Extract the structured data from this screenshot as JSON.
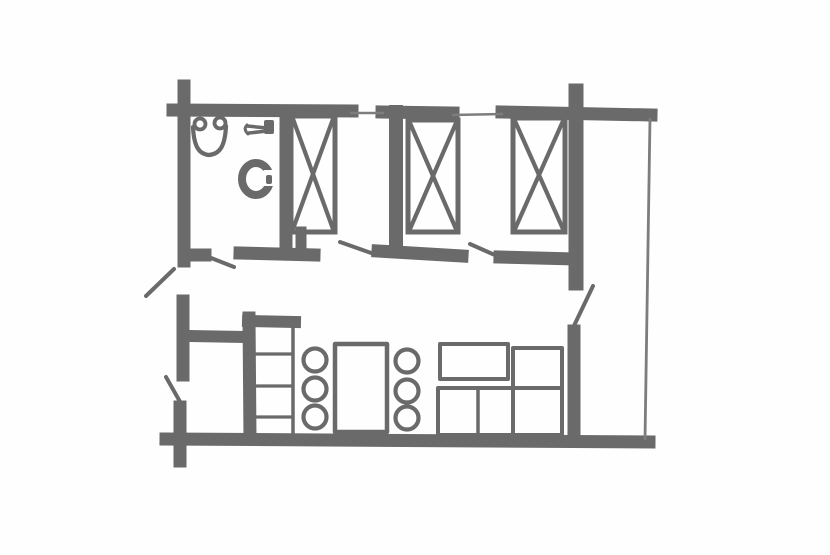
{
  "canvas": {
    "width": 830,
    "height": 555,
    "background": "#fefefe",
    "ink": "#6a6a6a",
    "ink_light": "#7d7d7d"
  },
  "floor_plan": {
    "description_items": [
      {
        "name": "top-wall-left",
        "kind": "wall",
        "x1": 173,
        "y1": 110,
        "x2": 352,
        "y2": 111,
        "sw": 13
      },
      {
        "name": "top-wall-mid",
        "kind": "wall",
        "x1": 382,
        "y1": 112,
        "x2": 453,
        "y2": 113,
        "sw": 13
      },
      {
        "name": "top-wall-right",
        "kind": "wall",
        "x1": 502,
        "y1": 112,
        "x2": 651,
        "y2": 115,
        "sw": 13
      },
      {
        "name": "left-wall-upper",
        "kind": "wall",
        "x1": 184,
        "y1": 86,
        "x2": 184,
        "y2": 261,
        "sw": 13
      },
      {
        "name": "bathroom-divider-wall",
        "kind": "wall",
        "x1": 286,
        "y1": 112,
        "x2": 286,
        "y2": 248,
        "sw": 13
      },
      {
        "name": "bathroom-door-stub",
        "kind": "wall",
        "x1": 189,
        "y1": 255,
        "x2": 205,
        "y2": 255,
        "sw": 13
      },
      {
        "name": "hall-wall-a",
        "kind": "wall",
        "x1": 240,
        "y1": 253,
        "x2": 314,
        "y2": 255,
        "sw": 13
      },
      {
        "name": "hall-wall-a-riser",
        "kind": "wall",
        "x1": 301,
        "y1": 232,
        "x2": 301,
        "y2": 250,
        "sw": 11
      },
      {
        "name": "bedroom-divider-wall",
        "kind": "wall",
        "x1": 396,
        "y1": 112,
        "x2": 396,
        "y2": 250,
        "sw": 14
      },
      {
        "name": "hall-wall-b",
        "kind": "wall",
        "x1": 378,
        "y1": 251,
        "x2": 462,
        "y2": 256,
        "sw": 13
      },
      {
        "name": "hall-wall-c",
        "kind": "wall",
        "x1": 500,
        "y1": 257,
        "x2": 574,
        "y2": 259,
        "sw": 13
      },
      {
        "name": "right-wall-upper",
        "kind": "wall",
        "x1": 576,
        "y1": 91,
        "x2": 576,
        "y2": 283,
        "sw": 15
      },
      {
        "name": "right-wall-lower",
        "kind": "wall",
        "x1": 574,
        "y1": 331,
        "x2": 574,
        "y2": 438,
        "sw": 13
      },
      {
        "name": "bottom-wall",
        "kind": "wall",
        "x1": 166,
        "y1": 439,
        "x2": 649,
        "y2": 442,
        "sw": 13
      },
      {
        "name": "left-wall-mid",
        "kind": "wall",
        "x1": 183,
        "y1": 301,
        "x2": 183,
        "y2": 375,
        "sw": 13
      },
      {
        "name": "left-wall-entry-stub",
        "kind": "wall",
        "x1": 180,
        "y1": 407,
        "x2": 180,
        "y2": 461,
        "sw": 13
      },
      {
        "name": "entry-room-wall",
        "kind": "wall",
        "x1": 189,
        "y1": 336,
        "x2": 246,
        "y2": 337,
        "sw": 12
      },
      {
        "name": "kitchen-wall",
        "kind": "wall",
        "x1": 249,
        "y1": 318,
        "x2": 250,
        "y2": 439,
        "sw": 13
      },
      {
        "name": "kitchen-counter-cap",
        "kind": "wall",
        "x1": 248,
        "y1": 321,
        "x2": 295,
        "y2": 322,
        "sw": 12
      },
      {
        "name": "window-1",
        "kind": "thin",
        "x1": 350,
        "y1": 113,
        "x2": 384,
        "y2": 113,
        "sw": 2.6
      },
      {
        "name": "window-2",
        "kind": "thin",
        "x1": 452,
        "y1": 115,
        "x2": 503,
        "y2": 114,
        "sw": 2.6
      },
      {
        "name": "balcony-edge-line",
        "kind": "thin",
        "x1": 650,
        "y1": 118,
        "x2": 645,
        "y2": 440,
        "sw": 2.8
      },
      {
        "name": "bathroom-door-leaf",
        "kind": "door",
        "x1": 196,
        "y1": 252,
        "x2": 234,
        "y2": 267,
        "sw": 4
      },
      {
        "name": "bedroom1-door-leaf",
        "kind": "door",
        "x1": 340,
        "y1": 242,
        "x2": 374,
        "y2": 254,
        "sw": 4
      },
      {
        "name": "bedroom2-door-leaf",
        "kind": "door",
        "x1": 470,
        "y1": 244,
        "x2": 497,
        "y2": 256,
        "sw": 4
      },
      {
        "name": "balcony-door-leaf",
        "kind": "door",
        "x1": 593,
        "y1": 286,
        "x2": 571,
        "y2": 332,
        "sw": 4
      },
      {
        "name": "side-door-leaf",
        "kind": "door",
        "x1": 174,
        "y1": 269,
        "x2": 146,
        "y2": 296,
        "sw": 4
      },
      {
        "name": "entry-door-leaf",
        "kind": "door",
        "x1": 166,
        "y1": 377,
        "x2": 183,
        "y2": 407,
        "sw": 4
      },
      {
        "name": "bed-1",
        "kind": "bed",
        "x": 291,
        "y": 116,
        "w": 44,
        "h": 116
      },
      {
        "name": "bed-2",
        "kind": "bed",
        "x": 408,
        "y": 120,
        "w": 50,
        "h": 112
      },
      {
        "name": "bed-3",
        "kind": "bed",
        "x": 513,
        "y": 118,
        "w": 52,
        "h": 114
      },
      {
        "name": "kitchen-counter-edge",
        "kind": "line",
        "x1": 293,
        "y1": 322,
        "x2": 293,
        "y2": 438,
        "sw": 3.5
      },
      {
        "name": "kitchen-counter-shelf-1",
        "kind": "line",
        "x1": 256,
        "y1": 354,
        "x2": 293,
        "y2": 354,
        "sw": 3.2
      },
      {
        "name": "kitchen-counter-shelf-2",
        "kind": "line",
        "x1": 256,
        "y1": 386,
        "x2": 293,
        "y2": 386,
        "sw": 3.2
      },
      {
        "name": "kitchen-counter-shelf-3",
        "kind": "line",
        "x1": 256,
        "y1": 417,
        "x2": 293,
        "y2": 417,
        "sw": 3.2
      },
      {
        "name": "dining-table",
        "kind": "rect",
        "x": 335,
        "y": 344,
        "w": 52,
        "h": 88,
        "sw": 4.5
      },
      {
        "name": "dining-chair-1",
        "kind": "circle",
        "cx": 315,
        "cy": 360,
        "r": 11.5,
        "sw": 4.2
      },
      {
        "name": "dining-chair-2",
        "kind": "circle",
        "cx": 315,
        "cy": 389,
        "r": 11.5,
        "sw": 4.2
      },
      {
        "name": "dining-chair-3",
        "kind": "circle",
        "cx": 315,
        "cy": 417,
        "r": 11.5,
        "sw": 4.2
      },
      {
        "name": "dining-chair-4",
        "kind": "circle",
        "cx": 407,
        "cy": 361,
        "r": 11.5,
        "sw": 4.2
      },
      {
        "name": "dining-chair-5",
        "kind": "circle",
        "cx": 407,
        "cy": 391,
        "r": 11.5,
        "sw": 4.2
      },
      {
        "name": "dining-chair-6",
        "kind": "circle",
        "cx": 407,
        "cy": 418,
        "r": 11.5,
        "sw": 4.2
      },
      {
        "name": "coffee-table",
        "kind": "rect",
        "x": 440,
        "y": 344,
        "w": 68,
        "h": 35,
        "sw": 4
      },
      {
        "name": "sofa-seat",
        "kind": "rect",
        "x": 438,
        "y": 388,
        "w": 124,
        "h": 47,
        "sw": 4
      },
      {
        "name": "sofa-corner",
        "kind": "rect",
        "x": 513,
        "y": 348,
        "w": 49,
        "h": 88,
        "sw": 4
      },
      {
        "name": "sofa-seat-divider",
        "kind": "line",
        "x1": 478,
        "y1": 389,
        "x2": 478,
        "y2": 434,
        "sw": 3.5
      },
      {
        "name": "bathroom-sink-bowl",
        "kind": "path",
        "d": "M 193 127 C 194 147 199 154 209 155 C 220 154 225 146 226 126",
        "sw": 4.2
      },
      {
        "name": "bathroom-sink-ear-left",
        "kind": "circle",
        "cx": 200,
        "cy": 124,
        "r": 5.5,
        "sw": 3.8
      },
      {
        "name": "bathroom-sink-ear-right",
        "kind": "circle",
        "cx": 220,
        "cy": 123,
        "r": 5.5,
        "sw": 3.8
      },
      {
        "name": "towel-holder-bar-1",
        "kind": "line",
        "x1": 247,
        "y1": 126,
        "x2": 267,
        "y2": 128,
        "sw": 3.5
      },
      {
        "name": "towel-holder-bar-2",
        "kind": "line",
        "x1": 249,
        "y1": 133,
        "x2": 267,
        "y2": 131,
        "sw": 3.5
      },
      {
        "name": "towel-holder-hook",
        "kind": "path",
        "d": "M 247 125 Q 243 129 248 134",
        "sw": 3
      },
      {
        "name": "towel-holder-base",
        "kind": "rect",
        "x": 264,
        "y": 120,
        "w": 10,
        "h": 14,
        "fill": "ink"
      },
      {
        "name": "toilet-bowl",
        "kind": "ellipse",
        "cx": 256,
        "cy": 179,
        "rx": 14,
        "ry": 16,
        "sw": 8
      },
      {
        "name": "toilet-seat-opening",
        "kind": "rect",
        "x": 263,
        "y": 170,
        "w": 14,
        "h": 16,
        "fill": "background"
      },
      {
        "name": "toilet-hinge",
        "kind": "rect",
        "x": 266,
        "y": 175,
        "w": 6,
        "h": 9,
        "fill": "ink"
      }
    ]
  }
}
